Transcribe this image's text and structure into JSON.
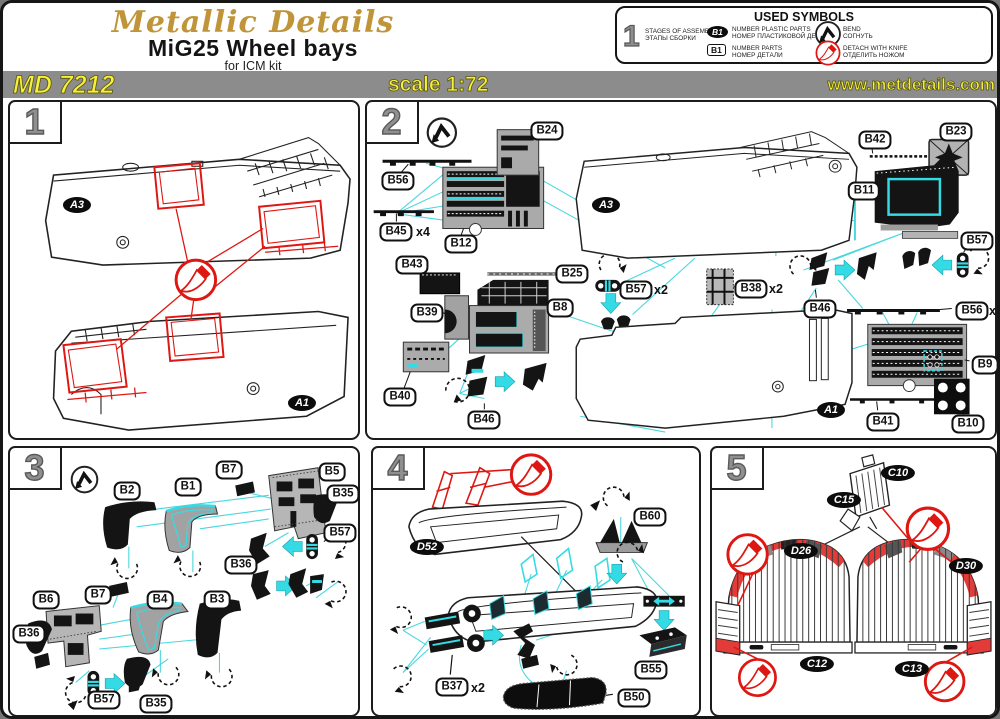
{
  "header": {
    "logo": "Metallic Details",
    "title": "MiG25 Wheel bays",
    "subtitle": "for ICM kit"
  },
  "bar": {
    "code": "MD 7212",
    "scale": "scale 1:72",
    "website": "www.metdetails.com"
  },
  "symbols": {
    "title": "USED SYMBOLS",
    "stage": {
      "symbol": "1",
      "en": "STAGES OF ASSEMBLY",
      "ru": "ЭТАПЫ СБОРКИ"
    },
    "plastic": {
      "symbol": "B1",
      "en": "NUMBER PLASTIC PARTS",
      "ru": "НОМЕР ПЛАСТИКОВОЙ ДЕТАЛИ"
    },
    "parts": {
      "symbol": "B1",
      "en": "NUMBER PARTS",
      "ru": "НОМЕР ДЕТАЛИ"
    },
    "bend": {
      "en": "BEND",
      "ru": "СОГНУТЬ"
    },
    "knife": {
      "en": "DETACH WITH KNIFE",
      "ru": "ОТДЕЛИТЬ НОЖОМ"
    }
  },
  "colors": {
    "accent_cyan": "#35dbe4",
    "red": "#de1712",
    "bar_yellow": "#f8ef3b",
    "bar_gray": "#8c8c8c",
    "gold": "#c0953a"
  },
  "steps": {
    "s1": {
      "num": "1",
      "a3": "A3",
      "a1": "A1"
    },
    "s2": {
      "num": "2",
      "b24": "B24",
      "b56": "B56",
      "b45": "B45",
      "b45x": "x4",
      "b12": "B12",
      "b43": "B43",
      "b39": "B39",
      "b25": "B25",
      "b8": "B8",
      "b57a": "B57",
      "b57ax": "x2",
      "b38": "B38",
      "b38x": "x2",
      "b40": "B40",
      "b46a": "B46",
      "b46b": "B46",
      "b42": "B42",
      "b23": "B23",
      "b11": "B11",
      "b57b": "B57",
      "b56b": "B56",
      "b56bx": "x4",
      "b9": "B9",
      "b41": "B41",
      "b10": "B10",
      "a3": "A3",
      "a1": "A1"
    },
    "s3": {
      "num": "3",
      "b2": "B2",
      "b1": "B1",
      "b7a": "B7",
      "b5": "B5",
      "b35a": "B35",
      "b57a": "B57",
      "b36a": "B36",
      "b6": "B6",
      "b7b": "B7",
      "b4": "B4",
      "b3": "B3",
      "b36b": "B36",
      "b57b": "B57",
      "b35b": "B35"
    },
    "s4": {
      "num": "4",
      "d52": "D52",
      "b60": "B60",
      "b37": "B37",
      "b37x": "x2",
      "b55": "B55",
      "b50": "B50"
    },
    "s5": {
      "num": "5",
      "c10": "C10",
      "c15": "C15",
      "d26": "D26",
      "d30": "D30",
      "c12": "C12",
      "c13": "C13"
    }
  }
}
